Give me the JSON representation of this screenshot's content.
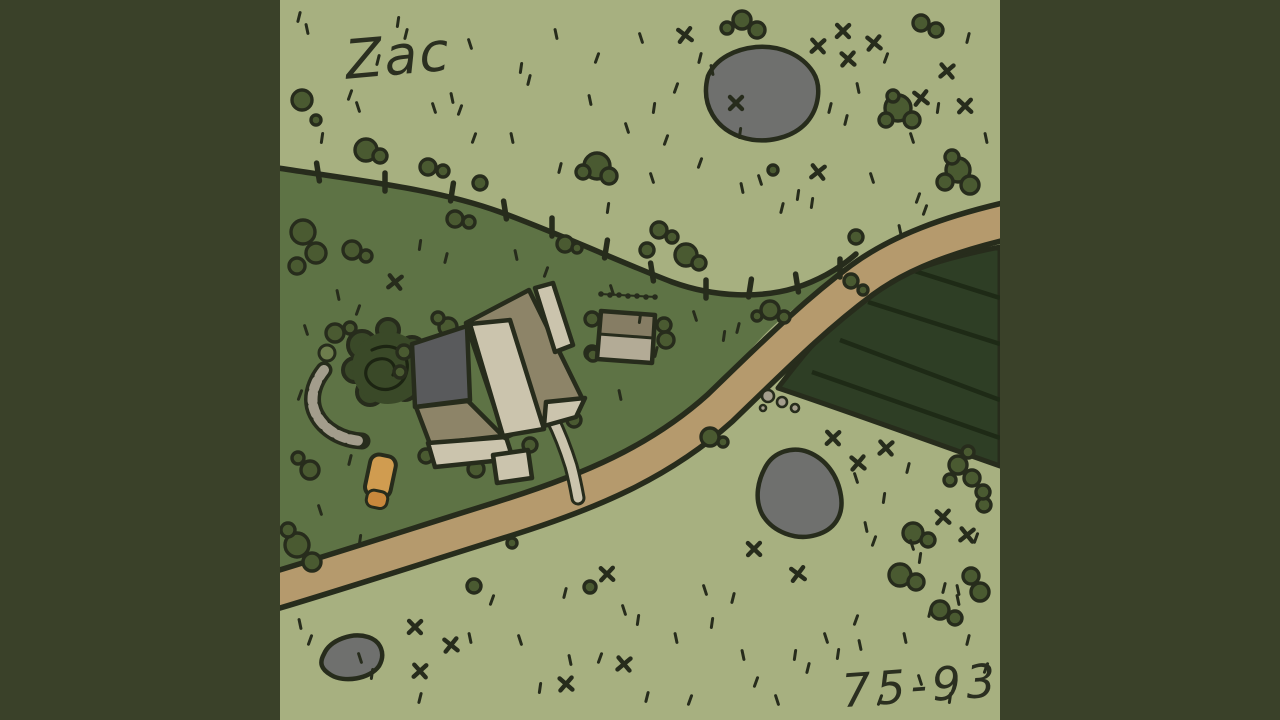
{
  "artwork": {
    "artist_signature": "Zac",
    "years_label": "75-93",
    "colors": {
      "outer": "#3a4129",
      "grass_light": "#a7b080",
      "grass_dark": "#5e7345",
      "crop_field": "#2e3e25",
      "furrow": "#1e2a16",
      "road": "#b59a6d",
      "ink": "#272c1c",
      "pond": "#6f706e",
      "bush": "#4a5a31",
      "light_bush": "#6e7d4d",
      "tree": "#3a4928",
      "tree_ink": "#1c2412",
      "roof_tan": "#8d8468",
      "roof_light": "#cbc4ad",
      "patio": "#595a5c",
      "shed_top": "#867d64",
      "shed_bottom": "#b3ab96",
      "stone": "#a39d8c",
      "car_orange": "#d09c50",
      "car_orange_dark": "#c9883c"
    },
    "scene": {
      "pasture_d": "M280,168 C370,182 440,190 500,212 C560,234 620,262 672,282 C716,298 762,298 795,288 C820,280 840,268 852,257 C838,274 818,292 795,308 C765,330 740,360 700,412 C660,462 610,478 560,492 C480,516 380,552 280,582 Z",
      "field_d": "M1000,247 C945,258 905,270 872,292 C845,310 820,332 778,388 C850,412 920,438 1000,466 Z",
      "furrows": [
        [
          868,
          302,
          1000,
          344
        ],
        [
          840,
          340,
          1000,
          400
        ],
        [
          812,
          372,
          1000,
          438
        ],
        [
          905,
          268,
          1000,
          298
        ]
      ],
      "road_d": "M1010,220 C950,234 900,252 862,280 C815,315 780,350 720,408 C660,462 590,492 500,520 C420,545 350,568 270,592",
      "fence_d": "M278,168 C370,182 440,190 500,212 C560,234 620,262 672,282 C716,298 762,298 795,288 C820,280 840,268 856,254",
      "fence_posts": [
        [
          318,
          172
        ],
        [
          385,
          182
        ],
        [
          452,
          192
        ],
        [
          505,
          210
        ],
        [
          552,
          227
        ],
        [
          606,
          249
        ],
        [
          652,
          272
        ],
        [
          706,
          289
        ],
        [
          750,
          288
        ],
        [
          797,
          283
        ],
        [
          840,
          268
        ]
      ],
      "ponds": [
        {
          "name": "pond-top",
          "d": "M708,76 C716,58 736,49 756,47 C780,45 802,55 813,72 C822,86 819,108 807,122 C793,138 765,145 741,137 C717,129 700,106 708,76 Z"
        },
        {
          "name": "pond-bottom-right",
          "d": "M766,466 C774,452 792,446 808,452 C826,459 838,476 841,496 C844,516 834,530 816,535 C796,541 772,532 762,514 C754,498 758,480 766,466 Z"
        },
        {
          "name": "pond-bottom-left",
          "d": "M324,654 C330,640 352,632 368,637 C381,641 386,654 379,666 C370,679 344,683 331,675 C321,669 319,663 324,654 Z"
        }
      ],
      "stone_arc_d": "M324,370 C313,384 309,400 316,414 C324,430 342,440 362,441",
      "tree": {
        "cx": 388,
        "cy": 368,
        "r": 36,
        "bumps": [
          [
            362,
            345,
            14
          ],
          [
            412,
            350,
            13
          ],
          [
            370,
            392,
            13
          ],
          [
            405,
            388,
            12
          ],
          [
            388,
            330,
            11
          ],
          [
            355,
            370,
            12
          ],
          [
            420,
            370,
            11
          ]
        ],
        "swirl_d": "M372,350 C392,340 410,352 407,370 C404,389 383,395 371,384 C361,375 366,361 379,359 C390,357 398,366 393,375"
      },
      "bushes": [
        [
          302,
          100,
          10
        ],
        [
          316,
          120,
          5
        ],
        [
          366,
          150,
          11
        ],
        [
          380,
          156,
          7
        ],
        [
          428,
          167,
          8
        ],
        [
          443,
          171,
          6
        ],
        [
          480,
          183,
          7
        ],
        [
          597,
          166,
          13
        ],
        [
          583,
          172,
          7
        ],
        [
          609,
          176,
          8
        ],
        [
          659,
          230,
          8
        ],
        [
          672,
          237,
          6
        ],
        [
          742,
          20,
          9
        ],
        [
          757,
          30,
          8
        ],
        [
          727,
          28,
          6
        ],
        [
          898,
          108,
          13
        ],
        [
          886,
          120,
          7
        ],
        [
          912,
          120,
          8
        ],
        [
          893,
          96,
          6
        ],
        [
          958,
          170,
          12
        ],
        [
          945,
          182,
          8
        ],
        [
          970,
          185,
          9
        ],
        [
          952,
          157,
          7
        ],
        [
          773,
          170,
          5
        ],
        [
          851,
          281,
          7
        ],
        [
          863,
          290,
          5
        ],
        [
          921,
          23,
          8
        ],
        [
          936,
          30,
          7
        ],
        [
          770,
          310,
          9
        ],
        [
          784,
          317,
          6
        ],
        [
          757,
          316,
          5
        ],
        [
          856,
          237,
          7
        ],
        [
          303,
          232,
          12
        ],
        [
          316,
          253,
          10
        ],
        [
          297,
          266,
          8
        ],
        [
          352,
          250,
          9
        ],
        [
          366,
          256,
          6
        ],
        [
          455,
          219,
          8
        ],
        [
          469,
          222,
          6
        ],
        [
          565,
          244,
          8
        ],
        [
          577,
          248,
          5
        ],
        [
          647,
          250,
          7
        ],
        [
          686,
          255,
          11
        ],
        [
          699,
          263,
          7
        ],
        [
          310,
          470,
          9
        ],
        [
          298,
          458,
          6
        ],
        [
          297,
          545,
          12
        ],
        [
          312,
          562,
          9
        ],
        [
          288,
          530,
          7
        ],
        [
          335,
          333,
          9
        ],
        [
          350,
          328,
          6
        ],
        [
          404,
          352,
          7
        ],
        [
          400,
          372,
          6
        ],
        [
          448,
          327,
          9
        ],
        [
          438,
          318,
          6
        ],
        [
          592,
          353,
          7
        ],
        [
          574,
          420,
          7
        ],
        [
          530,
          445,
          7
        ],
        [
          476,
          469,
          8
        ],
        [
          426,
          456,
          7
        ],
        [
          592,
          319,
          7
        ],
        [
          664,
          325,
          7
        ],
        [
          666,
          340,
          8
        ],
        [
          593,
          355,
          6
        ],
        [
          474,
          586,
          7
        ],
        [
          512,
          543,
          5
        ],
        [
          590,
          587,
          6
        ],
        [
          710,
          437,
          9
        ],
        [
          723,
          442,
          5
        ],
        [
          900,
          575,
          11
        ],
        [
          916,
          582,
          8
        ],
        [
          971,
          576,
          8
        ],
        [
          980,
          592,
          9
        ],
        [
          984,
          505,
          7
        ],
        [
          958,
          465,
          9
        ],
        [
          972,
          478,
          8
        ],
        [
          950,
          480,
          6
        ],
        [
          968,
          452,
          6
        ],
        [
          983,
          492,
          7
        ],
        [
          940,
          610,
          9
        ],
        [
          955,
          618,
          7
        ],
        [
          913,
          533,
          10
        ],
        [
          928,
          540,
          7
        ]
      ],
      "light_bushes": [
        [
          327,
          353,
          8
        ]
      ],
      "stones": [
        [
          768,
          396,
          6
        ],
        [
          782,
          402,
          5
        ],
        [
          795,
          408,
          4
        ],
        [
          763,
          408,
          3
        ]
      ],
      "driveway_d": "M552,418 C560,434 566,450 571,466 C574,477 576,487 578,498",
      "house_parts": [
        {
          "name": "patio-terrace",
          "fill": "patio",
          "d": "M412,344 L467,326 L470,400 L415,407 Z"
        },
        {
          "name": "house-wall-strip",
          "fill": "roof_tan",
          "d": "M416,407 L468,401 L503,436 L430,444 Z"
        },
        {
          "name": "house-front-strip",
          "fill": "roof_light",
          "d": "M428,443 L506,437 L513,459 L435,467 Z"
        },
        {
          "name": "house-roof-main",
          "fill": "roof_tan",
          "d": "M466,323 L529,290 L583,400 L505,438 Z"
        },
        {
          "name": "house-roof-light-slope",
          "fill": "roof_light",
          "d": "M470,324 L510,320 L544,429 L503,436 Z"
        },
        {
          "name": "house-wing-ne",
          "fill": "roof_light",
          "d": "M535,288 L553,283 L573,345 L555,352 Z"
        },
        {
          "name": "house-eave-se",
          "fill": "roof_light",
          "d": "M546,402 L585,398 L576,417 L544,426 Z"
        },
        {
          "name": "house-path-stub",
          "fill": "roof_light",
          "d": "M493,455 L528,450 L532,478 L497,483 Z"
        }
      ],
      "car": {
        "cx": 380,
        "cy": 478,
        "rotate": 12,
        "body": [
          367,
          455,
          26,
          42,
          9
        ],
        "hood": [
          371,
          491,
          21,
          17,
          7
        ]
      },
      "shed": {
        "outline_d": "M601,311 L655,315 L652,363 L597,359 Z",
        "top_d": "M601,311 L655,315 L653,338 L599,334 Z",
        "bottom_d": "M599,334 L653,338 L652,363 L597,359 Z",
        "divider": [
          599,
          334,
          653,
          338
        ],
        "dots_line": [
          600,
          294,
          656,
          297
        ],
        "dots": [
          [
            601,
            294
          ],
          [
            610,
            295
          ],
          [
            619,
            295
          ],
          [
            628,
            296
          ],
          [
            637,
            296
          ],
          [
            646,
            297
          ],
          [
            655,
            297
          ]
        ]
      },
      "grass_ticks": [
        [
          299,
          17
        ],
        [
          307,
          29
        ],
        [
          350,
          95
        ],
        [
          358,
          107
        ],
        [
          398,
          22
        ],
        [
          406,
          34
        ],
        [
          452,
          98
        ],
        [
          460,
          110
        ],
        [
          470,
          44
        ],
        [
          521,
          68
        ],
        [
          529,
          80
        ],
        [
          556,
          34
        ],
        [
          597,
          58
        ],
        [
          641,
          38
        ],
        [
          654,
          108
        ],
        [
          700,
          58
        ],
        [
          712,
          70
        ],
        [
          666,
          140
        ],
        [
          627,
          128
        ],
        [
          740,
          133
        ],
        [
          830,
          108
        ],
        [
          858,
          88
        ],
        [
          886,
          58
        ],
        [
          912,
          138
        ],
        [
          938,
          108
        ],
        [
          968,
          38
        ],
        [
          986,
          138
        ],
        [
          918,
          198
        ],
        [
          872,
          178
        ],
        [
          812,
          203
        ],
        [
          782,
          208
        ],
        [
          742,
          188
        ],
        [
          700,
          163
        ],
        [
          652,
          178
        ],
        [
          608,
          208
        ],
        [
          560,
          168
        ],
        [
          512,
          138
        ],
        [
          474,
          138
        ],
        [
          434,
          108
        ],
        [
          322,
          138
        ],
        [
          378,
          60
        ],
        [
          590,
          100
        ],
        [
          676,
          88
        ],
        [
          760,
          180
        ],
        [
          798,
          195
        ],
        [
          846,
          120
        ],
        [
          900,
          230
        ],
        [
          925,
          210
        ],
        [
          695,
          316
        ],
        [
          724,
          336
        ],
        [
          738,
          328
        ],
        [
          338,
          295
        ],
        [
          358,
          310
        ],
        [
          306,
          330
        ],
        [
          420,
          245
        ],
        [
          446,
          258
        ],
        [
          516,
          255
        ],
        [
          546,
          272
        ],
        [
          612,
          290
        ],
        [
          640,
          318
        ],
        [
          656,
          352
        ],
        [
          620,
          395
        ],
        [
          300,
          395
        ],
        [
          320,
          510
        ],
        [
          360,
          540
        ],
        [
          350,
          460
        ],
        [
          300,
          624
        ],
        [
          310,
          640
        ],
        [
          360,
          658
        ],
        [
          372,
          674
        ],
        [
          420,
          698
        ],
        [
          470,
          638
        ],
        [
          492,
          600
        ],
        [
          520,
          640
        ],
        [
          540,
          688
        ],
        [
          565,
          593
        ],
        [
          570,
          660
        ],
        [
          600,
          658
        ],
        [
          624,
          610
        ],
        [
          638,
          620
        ],
        [
          647,
          697
        ],
        [
          676,
          638
        ],
        [
          690,
          700
        ],
        [
          705,
          590
        ],
        [
          712,
          623
        ],
        [
          733,
          598
        ],
        [
          743,
          655
        ],
        [
          756,
          682
        ],
        [
          777,
          700
        ],
        [
          795,
          655
        ],
        [
          808,
          668
        ],
        [
          860,
          645
        ],
        [
          880,
          700
        ],
        [
          920,
          680
        ],
        [
          950,
          698
        ],
        [
          968,
          640
        ],
        [
          905,
          638
        ],
        [
          856,
          620
        ],
        [
          826,
          638
        ],
        [
          838,
          654
        ],
        [
          930,
          612
        ],
        [
          958,
          590
        ],
        [
          986,
          668
        ],
        [
          856,
          478
        ],
        [
          884,
          498
        ],
        [
          908,
          468
        ],
        [
          866,
          527
        ],
        [
          874,
          541
        ],
        [
          912,
          545
        ],
        [
          920,
          558
        ],
        [
          944,
          588
        ],
        [
          958,
          600
        ],
        [
          976,
          538
        ]
      ],
      "x_marks": [
        [
          685,
          35
        ],
        [
          843,
          31
        ],
        [
          874,
          43
        ],
        [
          818,
          46
        ],
        [
          848,
          59
        ],
        [
          947,
          71
        ],
        [
          965,
          106
        ],
        [
          818,
          172
        ],
        [
          736,
          103
        ],
        [
          921,
          98
        ],
        [
          833,
          438
        ],
        [
          858,
          463
        ],
        [
          886,
          448
        ],
        [
          943,
          517
        ],
        [
          967,
          535
        ],
        [
          754,
          549
        ],
        [
          798,
          574
        ],
        [
          415,
          627
        ],
        [
          451,
          645
        ],
        [
          420,
          671
        ],
        [
          566,
          684
        ],
        [
          624,
          664
        ],
        [
          607,
          574
        ],
        [
          395,
          282
        ]
      ]
    }
  }
}
